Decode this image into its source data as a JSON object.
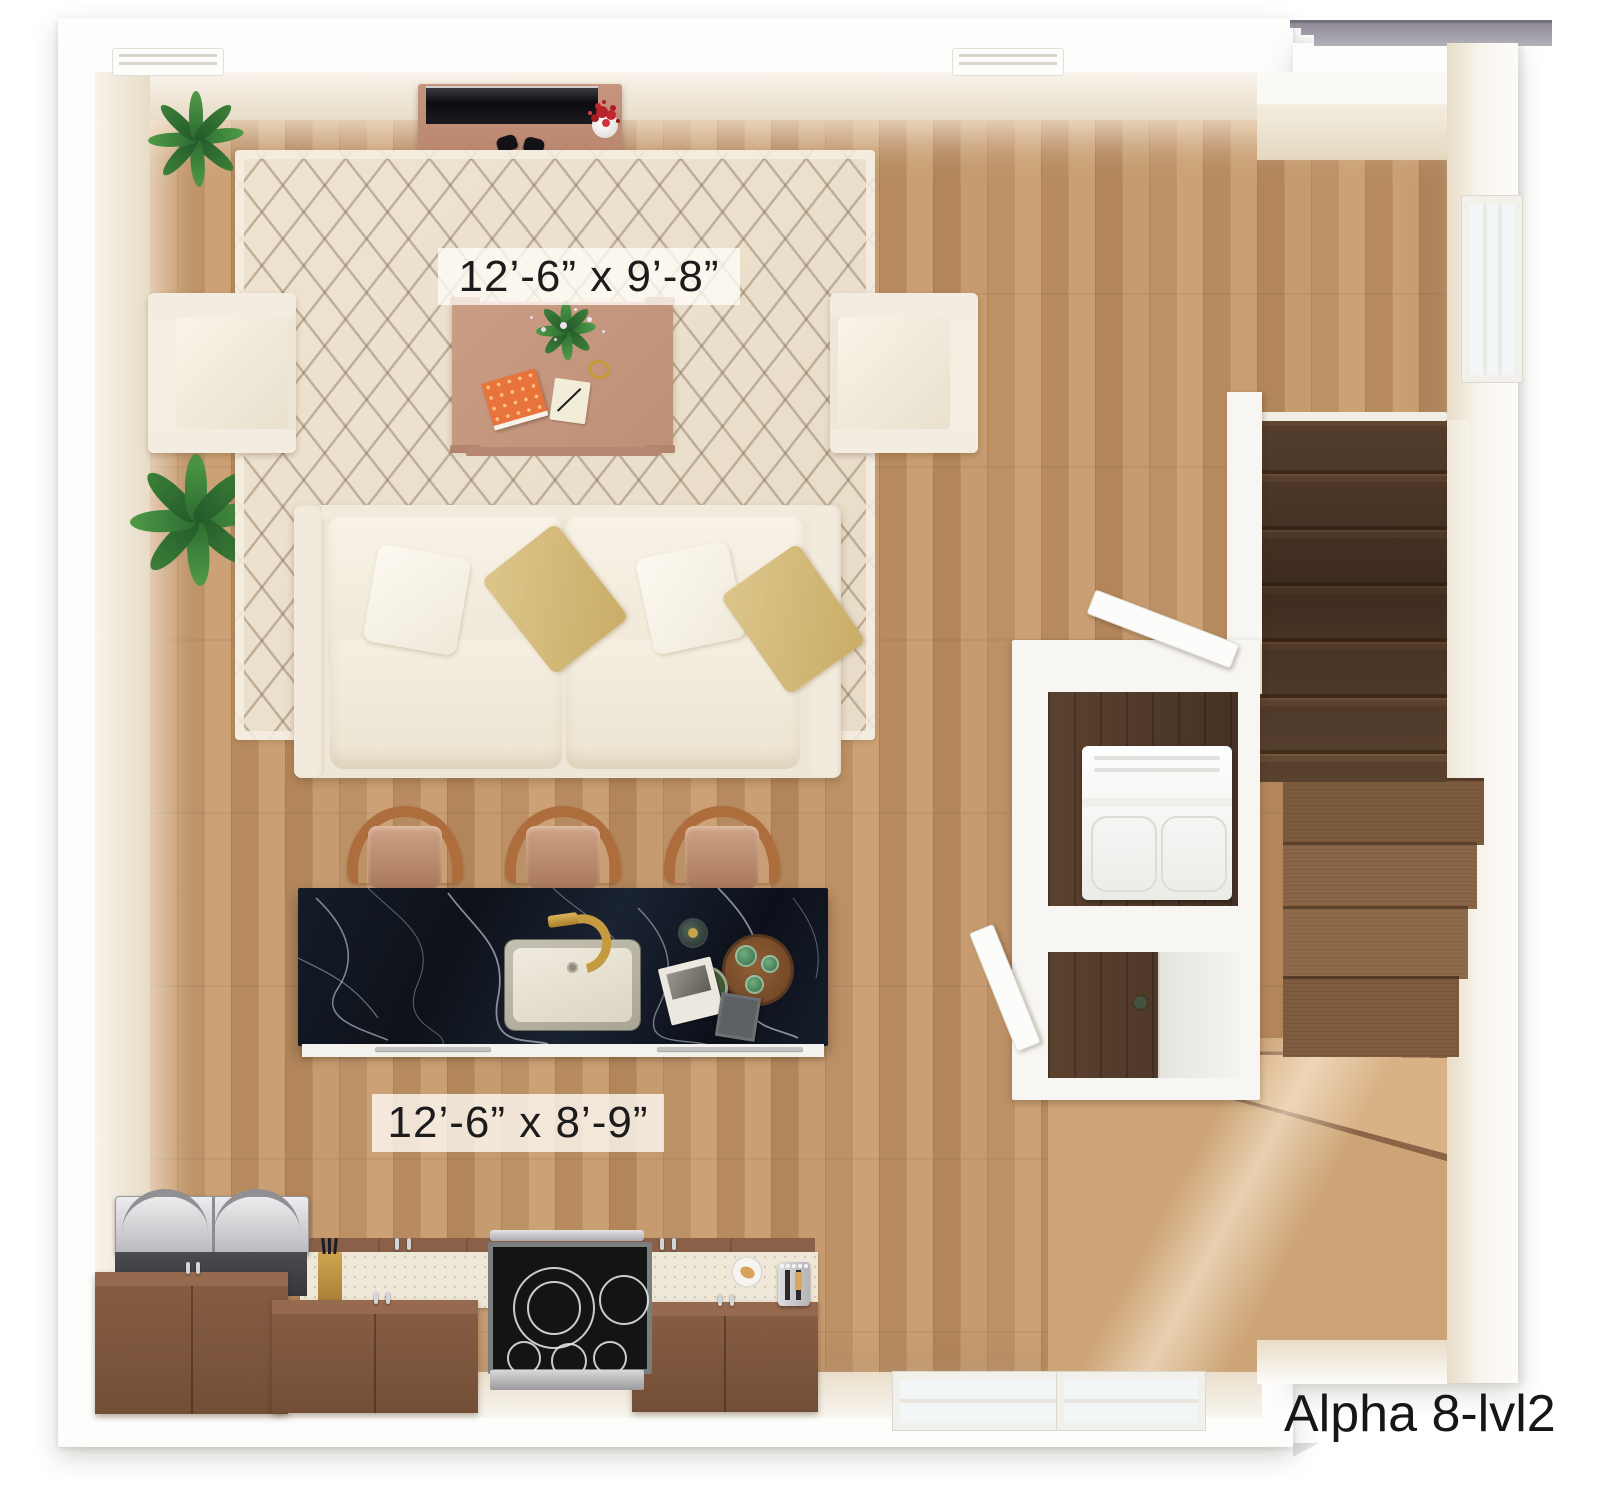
{
  "plan": {
    "title": "Alpha 8-lvl2",
    "living_room_label": "12’-6” x 9’-8”",
    "kitchen_label": "12’-6” x 8’-9”"
  },
  "colors": {
    "page_background": "#ffffff",
    "wall_face": "#e9dfcc",
    "floor_wood": "#c59b6f",
    "stair_dark_wood": "#5c4431",
    "stair_winder_wood": "#8a6547",
    "stair_landing_wood": "#cda476",
    "island_marble": "#131a26",
    "island_vein": "#d7dde8",
    "cabinet_wood": "#855d43",
    "counter": "#efe8d8",
    "rug": "#ece1cf",
    "rug_pattern": "#7d664a",
    "sofa_fabric": "#eee6d7",
    "accent_pillow_gold": "#d0b574",
    "stool_wood": "#ad6d3d",
    "console_wood": "#c6957e",
    "plant_green": "#3f8a3f",
    "flower_red": "#b8242b",
    "label_band": "#fffdf7",
    "text": "#1c1c1c",
    "roof_gray": "#a5a1ac"
  },
  "rooms": {
    "living_room": {
      "furniture": [
        "media-console",
        "tv",
        "game-controller",
        "game-controller",
        "flower-vase",
        "area-rug",
        "armchair",
        "armchair",
        "coffee-table",
        "table-plant",
        "book",
        "notepad",
        "gold-ring",
        "sofa",
        "white-pillow",
        "white-pillow",
        "gold-pillow",
        "gold-pillow",
        "potted-fern",
        "potted-banana-plant",
        "ceiling-vent",
        "ceiling-vent"
      ]
    },
    "kitchen": {
      "furniture": [
        "marble-island",
        "undermount-sink",
        "gold-faucet",
        "bar-stool",
        "bar-stool",
        "bar-stool",
        "bottle",
        "serving-tray",
        "lemon-bowl",
        "magazine",
        "napkin",
        "grill-appliance",
        "base-cabinet",
        "base-cabinet",
        "base-cabinet",
        "knife-block",
        "range-cooktop",
        "plate-with-croissant",
        "toaster"
      ]
    },
    "stair_hall": {
      "features": [
        "staircase-upper-run",
        "staircase-winders",
        "staircase-landing-fan",
        "railing-wall",
        "laundry-closet",
        "stacked-washer-dryer",
        "closet-door",
        "closet-door",
        "sliding-door",
        "side-window",
        "bottom-window",
        "bottom-window",
        "roof-ledge"
      ]
    }
  }
}
